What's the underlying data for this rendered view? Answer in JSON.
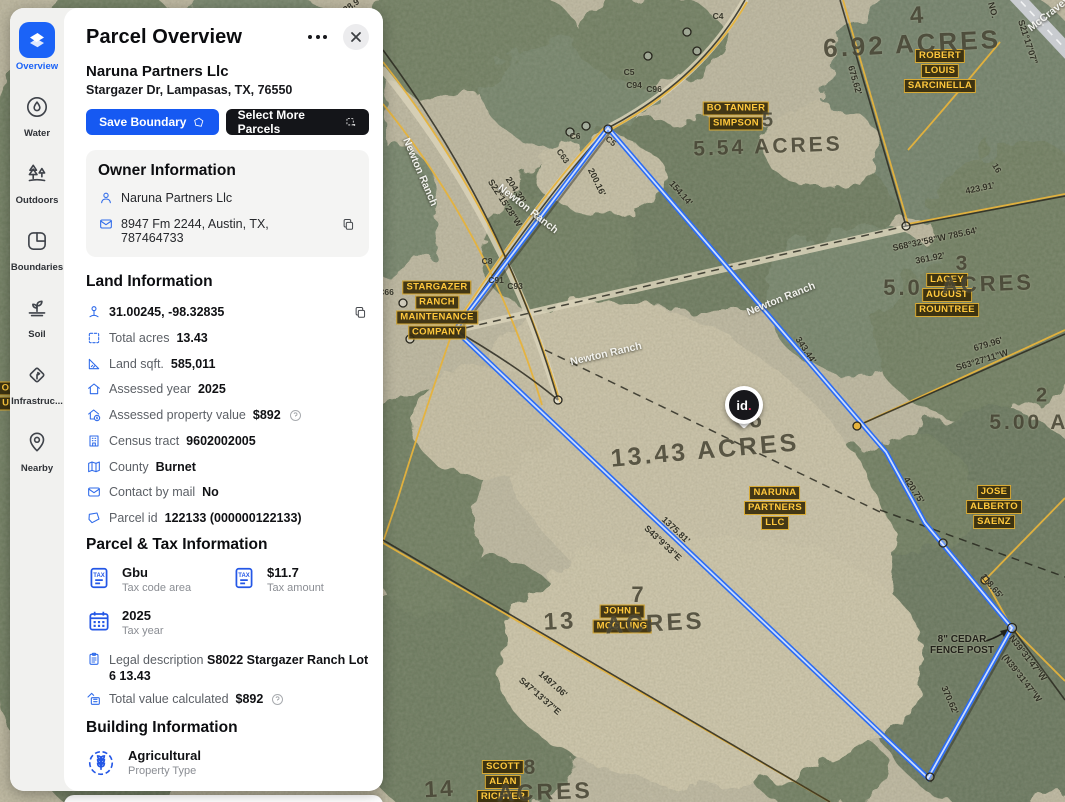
{
  "sidebar": {
    "items": [
      {
        "label": "Overview",
        "active": true
      },
      {
        "label": "Water",
        "active": false
      },
      {
        "label": "Outdoors",
        "active": false
      },
      {
        "label": "Boundaries",
        "active": false
      },
      {
        "label": "Soil",
        "active": false
      },
      {
        "label": "Infrastruc...",
        "active": false
      },
      {
        "label": "Nearby",
        "active": false
      }
    ]
  },
  "panel": {
    "title": "Parcel Overview",
    "owner_name": "Naruna Partners Llc",
    "address": "Stargazer Dr, Lampasas, TX, 76550",
    "save_button": "Save Boundary",
    "select_more_button": "Select More Parcels",
    "owner_info": {
      "heading": "Owner Information",
      "owner": "Naruna Partners Llc",
      "mailing_address": "8947 Fm 2244, Austin, TX, 787464733"
    },
    "land_info": {
      "heading": "Land Information",
      "rows": [
        {
          "label": "",
          "value": "31.00245, -98.32835"
        },
        {
          "label": "Total acres",
          "value": "13.43"
        },
        {
          "label": "Land sqft.",
          "value": "585,011"
        },
        {
          "label": "Assessed year",
          "value": "2025"
        },
        {
          "label": "Assessed property value",
          "value": "$892"
        },
        {
          "label": "Census tract",
          "value": "9602002005"
        },
        {
          "label": "County",
          "value": "Burnet"
        },
        {
          "label": "Contact by mail",
          "value": "No"
        },
        {
          "label": "Parcel id",
          "value": "122133 (000000122133)"
        }
      ]
    },
    "parcel_tax": {
      "heading": "Parcel & Tax Information",
      "cards": [
        {
          "value": "Gbu",
          "label": "Tax code area"
        },
        {
          "value": "$11.7",
          "label": "Tax amount"
        },
        {
          "value": "2025",
          "label": "Tax year"
        }
      ],
      "legal": {
        "label": "Legal description",
        "value": "S8022 Stargazer Ranch Lot 6 13.43"
      },
      "total_value": {
        "label": "Total value calculated",
        "value": "$892"
      }
    },
    "building_info": {
      "heading": "Building Information",
      "property_type": "Agricultural",
      "property_type_label": "Property Type"
    }
  },
  "map": {
    "pin_text": "id",
    "pin_dot": ".",
    "cedar_note": {
      "line1": "8\" CEDAR",
      "line2": "FENCE POST"
    },
    "owner_labels": [
      {
        "lines": [
          "ROBERT",
          "LOUIS",
          "SARCINELLA"
        ],
        "x": 940,
        "y": 71
      },
      {
        "lines": [
          "BO TANNER",
          "SIMPSON"
        ],
        "x": 736,
        "y": 116
      },
      {
        "lines": [
          "LACEY",
          "AUGUST",
          "ROUNTREE"
        ],
        "x": 947,
        "y": 295
      },
      {
        "lines": [
          "STARGAZER",
          "RANCH",
          "MAINTENANCE",
          "COMPANY"
        ],
        "x": 437,
        "y": 310
      },
      {
        "lines": [
          "NARUNA",
          "PARTNERS",
          "LLC"
        ],
        "x": 775,
        "y": 508
      },
      {
        "lines": [
          "JOHN L",
          "MCCLUNG"
        ],
        "x": 622,
        "y": 619
      },
      {
        "lines": [
          "JOSE",
          "ALBERTO",
          "SAENZ"
        ],
        "x": 994,
        "y": 507
      },
      {
        "lines": [
          "SCOTT",
          "ALAN",
          "RICHTER"
        ],
        "x": 503,
        "y": 782
      },
      {
        "lines": [
          "OH",
          "UE"
        ],
        "x": 9,
        "y": 396
      }
    ],
    "acre_labels": [
      {
        "t": "4",
        "x": 918,
        "y": 16,
        "s": 24,
        "r": -4
      },
      {
        "t": "6.92 ACRES",
        "x": 912,
        "y": 44,
        "s": 26,
        "r": -3
      },
      {
        "t": "5",
        "x": 769,
        "y": 121,
        "s": 20,
        "r": 0
      },
      {
        "t": "5.54 ACRES",
        "x": 768,
        "y": 147,
        "s": 21,
        "r": -2
      },
      {
        "t": "3",
        "x": 963,
        "y": 264,
        "s": 21,
        "r": 0
      },
      {
        "t": "5.0",
        "x": 903,
        "y": 288,
        "s": 22,
        "r": 0
      },
      {
        "t": "ACRES",
        "x": 988,
        "y": 284,
        "s": 22,
        "r": -2
      },
      {
        "t": "2",
        "x": 1043,
        "y": 396,
        "s": 20,
        "r": 0
      },
      {
        "t": "5.00 AC",
        "x": 1038,
        "y": 423,
        "s": 21,
        "r": 0
      },
      {
        "t": "6",
        "x": 757,
        "y": 420,
        "s": 23,
        "r": 0
      },
      {
        "t": "13.43  ACRES",
        "x": 705,
        "y": 451,
        "s": 25,
        "r": -5
      },
      {
        "t": "7",
        "x": 639,
        "y": 595,
        "s": 22,
        "r": 0
      },
      {
        "t": "13",
        "x": 560,
        "y": 622,
        "s": 24,
        "r": -3
      },
      {
        "t": "ACRES",
        "x": 655,
        "y": 624,
        "s": 24,
        "r": -3
      },
      {
        "t": "8",
        "x": 531,
        "y": 768,
        "s": 21,
        "r": 0
      },
      {
        "t": "14",
        "x": 440,
        "y": 789,
        "s": 23,
        "r": -3
      },
      {
        "t": "ACRES",
        "x": 545,
        "y": 792,
        "s": 23,
        "r": -2
      }
    ],
    "dim_labels": [
      {
        "t": "200.16'",
        "x": 597,
        "y": 182,
        "r": 64
      },
      {
        "t": "154.14'",
        "x": 681,
        "y": 193,
        "r": 48
      },
      {
        "t": "204.30'",
        "x": 516,
        "y": 190,
        "r": 57
      },
      {
        "t": "S22°15'28\"W",
        "x": 505,
        "y": 203,
        "r": 57
      },
      {
        "t": "343.44'",
        "x": 806,
        "y": 350,
        "r": 56
      },
      {
        "t": "675.62'",
        "x": 855,
        "y": 80,
        "r": 74
      },
      {
        "t": "423.91'",
        "x": 980,
        "y": 188,
        "r": -12
      },
      {
        "t": "S68°32'58\"W  785.64'",
        "x": 935,
        "y": 239,
        "r": -12
      },
      {
        "t": "361.92'",
        "x": 930,
        "y": 258,
        "r": -11
      },
      {
        "t": "679.96'",
        "x": 988,
        "y": 344,
        "r": -17
      },
      {
        "t": "S63°27'11\"W",
        "x": 982,
        "y": 360,
        "r": -17
      },
      {
        "t": "420.75'",
        "x": 914,
        "y": 490,
        "r": 56
      },
      {
        "t": "118.65'",
        "x": 992,
        "y": 586,
        "r": 50
      },
      {
        "t": "370.62'",
        "x": 950,
        "y": 700,
        "r": 66
      },
      {
        "t": "N39°31'47\"W",
        "x": 1028,
        "y": 658,
        "r": 52
      },
      {
        "t": "(N39°31'47\"W",
        "x": 1022,
        "y": 678,
        "r": 52
      },
      {
        "t": "1375.81'",
        "x": 676,
        "y": 530,
        "r": 43
      },
      {
        "t": "S43°9'33\"E",
        "x": 663,
        "y": 543,
        "r": 43
      },
      {
        "t": "1497.06'",
        "x": 553,
        "y": 684,
        "r": 41
      },
      {
        "t": "S47°13'37\"E",
        "x": 540,
        "y": 696,
        "r": 41
      },
      {
        "t": "NO.",
        "x": 993,
        "y": 10,
        "r": 75
      },
      {
        "t": "S21°17'07\"",
        "x": 1028,
        "y": 42,
        "r": 72
      },
      {
        "t": "28.9'",
        "x": 352,
        "y": 5,
        "r": -35
      }
    ],
    "curve_labels": [
      {
        "t": "C5",
        "x": 629,
        "y": 72,
        "r": 0
      },
      {
        "t": "C94",
        "x": 634,
        "y": 85,
        "r": 0
      },
      {
        "t": "C96",
        "x": 654,
        "y": 89,
        "r": 0
      },
      {
        "t": "C6",
        "x": 575,
        "y": 136,
        "r": 0
      },
      {
        "t": "C5",
        "x": 611,
        "y": 141,
        "r": 40
      },
      {
        "t": "C63",
        "x": 563,
        "y": 156,
        "r": 55
      },
      {
        "t": "C4",
        "x": 718,
        "y": 16,
        "r": 0
      },
      {
        "t": "C8",
        "x": 487,
        "y": 261,
        "r": 0
      },
      {
        "t": "C91",
        "x": 496,
        "y": 280,
        "r": 0
      },
      {
        "t": "C93",
        "x": 515,
        "y": 286,
        "r": 0
      },
      {
        "t": "C66",
        "x": 386,
        "y": 292,
        "r": 0
      },
      {
        "t": "16",
        "x": 997,
        "y": 168,
        "r": 60
      }
    ],
    "road_labels": [
      {
        "t": "Newton Ranch",
        "x": 420,
        "y": 172,
        "r": 67
      },
      {
        "t": "Newton Ranch",
        "x": 528,
        "y": 209,
        "r": 38
      },
      {
        "t": "Newton Ranch",
        "x": 781,
        "y": 299,
        "r": -22
      },
      {
        "t": "Newton Ranch",
        "x": 606,
        "y": 354,
        "r": -13
      },
      {
        "t": "McCravey",
        "x": 1049,
        "y": 14,
        "r": -38
      }
    ]
  },
  "colors": {
    "accent_blue": "#1b63f7",
    "dark_button": "#141519",
    "boundary_blue": "#2b6cf4",
    "map_label_yellow": "#ffc83d"
  }
}
